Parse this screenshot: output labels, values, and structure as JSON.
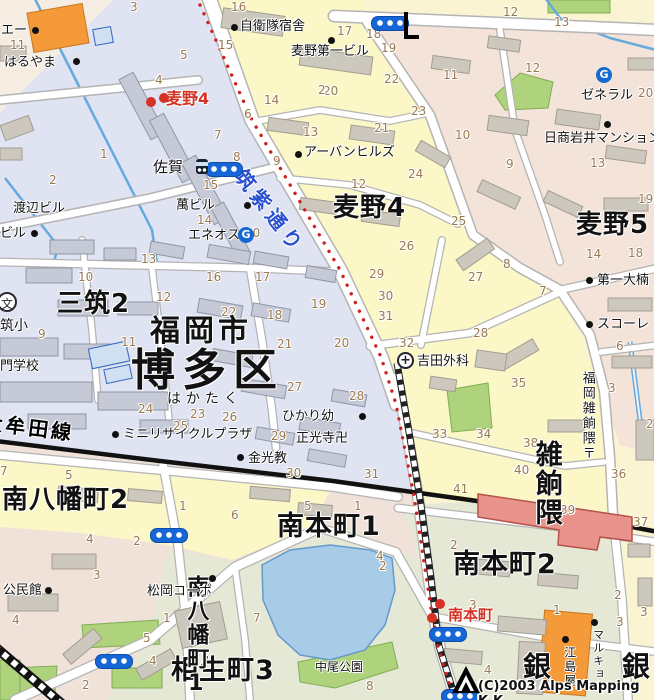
{
  "colors": {
    "ward_boundary_red": "#cc2222",
    "road_name_blue": "#2b50d0",
    "railway_black": "#111111",
    "water_blue": "#a8cbe8",
    "park_green": "#afd27c",
    "station_pink": "#e8948c",
    "store_orange": "#f49a38",
    "signal_blue": "#1766d6",
    "hakata_area_blue": "#dfe3f2",
    "mugino_area_yellow": "#fbf7c6"
  },
  "copyright": {
    "text": "(C)2003 Alps Mapping K.K."
  },
  "districts": [
    {
      "t": "麦野4",
      "x": 333,
      "y": 195,
      "s": 26
    },
    {
      "t": "麦野5",
      "x": 576,
      "y": 212,
      "s": 26
    },
    {
      "t": "三筑2",
      "x": 57,
      "y": 291,
      "s": 26
    },
    {
      "t": "福岡市",
      "x": 150,
      "y": 316,
      "s": 30,
      "c": "ls4"
    },
    {
      "t": "博多区",
      "x": 131,
      "y": 348,
      "s": 44,
      "c": "ls6"
    },
    {
      "t": "はかたく",
      "x": 167,
      "y": 392,
      "s": 14,
      "c": "ls5"
    },
    {
      "t": "南八幡町2",
      "x": 2,
      "y": 487,
      "s": 26
    },
    {
      "t": "南八幡町1",
      "x": 184,
      "y": 575,
      "s": 22,
      "c": "vert"
    },
    {
      "t": "南本町1",
      "x": 277,
      "y": 513,
      "s": 27
    },
    {
      "t": "南本町2",
      "x": 453,
      "y": 551,
      "s": 27
    },
    {
      "t": "相生町3",
      "x": 171,
      "y": 657,
      "s": 27
    },
    {
      "t": "雑餉隈",
      "x": 531,
      "y": 440,
      "s": 27,
      "c": "vert"
    },
    {
      "t": "銀",
      "x": 523,
      "y": 652,
      "s": 28
    },
    {
      "t": "銀",
      "x": 622,
      "y": 652,
      "s": 28
    }
  ],
  "street_labels": [
    {
      "t": "筑紫通り",
      "x": 247,
      "y": 166,
      "r": 52,
      "s": 20,
      "c": "roadname"
    },
    {
      "t": "大牟田線",
      "x": -16,
      "y": 412,
      "r": 7,
      "s": 20,
      "c": "railname"
    }
  ],
  "pois": [
    {
      "t": "自衛隊宿舎",
      "x": 240,
      "y": 20
    },
    {
      "t": "麦野第一ビル",
      "x": 291,
      "y": 45
    },
    {
      "t": "はるやま",
      "x": 4,
      "y": 56
    },
    {
      "t": "エー",
      "x": 1,
      "y": 24
    },
    {
      "t": "渡辺ビル",
      "x": 13,
      "y": 202
    },
    {
      "t": "ビル",
      "x": 0,
      "y": 227
    },
    {
      "t": "萬ビル",
      "x": 176,
      "y": 199
    },
    {
      "t": "エネオス",
      "x": 188,
      "y": 229
    },
    {
      "t": "アーバンヒルズ",
      "x": 304,
      "y": 146
    },
    {
      "t": "ゼネラル",
      "x": 581,
      "y": 89
    },
    {
      "t": "日商岩井マンション",
      "x": 544,
      "y": 132
    },
    {
      "t": "第一大楠",
      "x": 597,
      "y": 274
    },
    {
      "t": "スコーレ",
      "x": 597,
      "y": 318
    },
    {
      "t": "吉田外科",
      "x": 417,
      "y": 355
    },
    {
      "t": "ひかり幼",
      "x": 282,
      "y": 410
    },
    {
      "t": "正光寺卍",
      "x": 296,
      "y": 432
    },
    {
      "t": "金光教",
      "x": 248,
      "y": 452
    },
    {
      "t": "ミニリサイクルプラザ",
      "x": 123,
      "y": 428
    },
    {
      "t": "公民館",
      "x": 3,
      "y": 584
    },
    {
      "t": "松岡コーポ",
      "x": 147,
      "y": 585
    },
    {
      "t": "中尾公園",
      "x": 315,
      "y": 661,
      "s": 12
    },
    {
      "t": "佐賀",
      "x": 153,
      "y": 160,
      "s": 15
    },
    {
      "t": "筑小",
      "x": 0,
      "y": 319,
      "s": 14
    },
    {
      "t": "門学校",
      "x": 0,
      "y": 360
    },
    {
      "t": "江島屋",
      "x": 563,
      "y": 646,
      "s": 12,
      "c": "vert"
    },
    {
      "t": "マルキョウ",
      "x": 592,
      "y": 629,
      "s": 11,
      "c": "vert"
    },
    {
      "t": "福岡雑餉隈〒",
      "x": 580,
      "y": 371,
      "s": 13,
      "c": "vert"
    }
  ],
  "red_stops": [
    {
      "t": "麦野4",
      "x": 166,
      "y": 91,
      "s": 16
    },
    {
      "t": "南本町",
      "x": 448,
      "y": 608,
      "s": 15
    }
  ],
  "numbers": [
    {
      "t": "3",
      "x": 130,
      "y": 1
    },
    {
      "t": "16",
      "x": 231,
      "y": 1
    },
    {
      "t": "17",
      "x": 337,
      "y": 25
    },
    {
      "t": "18",
      "x": 366,
      "y": 28
    },
    {
      "t": "19",
      "x": 381,
      "y": 42
    },
    {
      "t": "12",
      "x": 503,
      "y": 6
    },
    {
      "t": "13",
      "x": 554,
      "y": 16
    },
    {
      "t": "15",
      "x": 218,
      "y": 39
    },
    {
      "t": "5",
      "x": 180,
      "y": 49
    },
    {
      "t": "4",
      "x": 155,
      "y": 74
    },
    {
      "t": "2",
      "x": 318,
      "y": 84
    },
    {
      "t": "14",
      "x": 264,
      "y": 94
    },
    {
      "t": "22",
      "x": 384,
      "y": 73
    },
    {
      "t": "20",
      "x": 323,
      "y": 85
    },
    {
      "t": "6",
      "x": 244,
      "y": 108
    },
    {
      "t": "11",
      "x": 443,
      "y": 69
    },
    {
      "t": "12",
      "x": 525,
      "y": 62
    },
    {
      "t": "13",
      "x": 303,
      "y": 126
    },
    {
      "t": "7",
      "x": 214,
      "y": 129
    },
    {
      "t": "8",
      "x": 233,
      "y": 151
    },
    {
      "t": "9",
      "x": 273,
      "y": 155
    },
    {
      "t": "20",
      "x": 638,
      "y": 87
    },
    {
      "t": "10",
      "x": 455,
      "y": 129
    },
    {
      "t": "9",
      "x": 506,
      "y": 158
    },
    {
      "t": "13",
      "x": 590,
      "y": 157
    },
    {
      "t": "19",
      "x": 638,
      "y": 193
    },
    {
      "t": "23",
      "x": 411,
      "y": 105
    },
    {
      "t": "21",
      "x": 374,
      "y": 122
    },
    {
      "t": "24",
      "x": 408,
      "y": 168
    },
    {
      "t": "12",
      "x": 351,
      "y": 178
    },
    {
      "t": "25",
      "x": 451,
      "y": 215
    },
    {
      "t": "15",
      "x": 203,
      "y": 179
    },
    {
      "t": "14",
      "x": 197,
      "y": 214
    },
    {
      "t": "1",
      "x": 100,
      "y": 148
    },
    {
      "t": "11",
      "x": 10,
      "y": 39
    },
    {
      "t": "2",
      "x": 49,
      "y": 174
    },
    {
      "t": "10",
      "x": 245,
      "y": 227
    },
    {
      "t": "13",
      "x": 141,
      "y": 253
    },
    {
      "t": "10",
      "x": 78,
      "y": 271
    },
    {
      "t": "12",
      "x": 156,
      "y": 291
    },
    {
      "t": "16",
      "x": 206,
      "y": 271
    },
    {
      "t": "17",
      "x": 255,
      "y": 271
    },
    {
      "t": "9",
      "x": 38,
      "y": 328
    },
    {
      "t": "11",
      "x": 121,
      "y": 336
    },
    {
      "t": "22",
      "x": 221,
      "y": 306
    },
    {
      "t": "18",
      "x": 267,
      "y": 309
    },
    {
      "t": "19",
      "x": 311,
      "y": 298
    },
    {
      "t": "21",
      "x": 277,
      "y": 338
    },
    {
      "t": "24",
      "x": 138,
      "y": 403
    },
    {
      "t": "23",
      "x": 190,
      "y": 408
    },
    {
      "t": "26",
      "x": 222,
      "y": 411
    },
    {
      "t": "27",
      "x": 287,
      "y": 381
    },
    {
      "t": "25",
      "x": 173,
      "y": 420
    },
    {
      "t": "29",
      "x": 271,
      "y": 430
    },
    {
      "t": "30",
      "x": 286,
      "y": 467
    },
    {
      "t": "31",
      "x": 364,
      "y": 468
    },
    {
      "t": "33",
      "x": 432,
      "y": 428
    },
    {
      "t": "26",
      "x": 399,
      "y": 240
    },
    {
      "t": "29",
      "x": 369,
      "y": 268
    },
    {
      "t": "30",
      "x": 378,
      "y": 290
    },
    {
      "t": "31",
      "x": 378,
      "y": 310
    },
    {
      "t": "32",
      "x": 399,
      "y": 337
    },
    {
      "t": "27",
      "x": 468,
      "y": 271
    },
    {
      "t": "28",
      "x": 473,
      "y": 327
    },
    {
      "t": "8",
      "x": 503,
      "y": 258
    },
    {
      "t": "7",
      "x": 539,
      "y": 285
    },
    {
      "t": "14",
      "x": 586,
      "y": 248
    },
    {
      "t": "18",
      "x": 628,
      "y": 247
    },
    {
      "t": "20",
      "x": 334,
      "y": 337
    },
    {
      "t": "28",
      "x": 349,
      "y": 390
    },
    {
      "t": "35",
      "x": 511,
      "y": 377
    },
    {
      "t": "34",
      "x": 476,
      "y": 428
    },
    {
      "t": "38",
      "x": 523,
      "y": 437
    },
    {
      "t": "6",
      "x": 616,
      "y": 340
    },
    {
      "t": "3",
      "x": 608,
      "y": 382
    },
    {
      "t": "2",
      "x": 646,
      "y": 418
    },
    {
      "t": "40",
      "x": 514,
      "y": 464
    },
    {
      "t": "41",
      "x": 453,
      "y": 483
    },
    {
      "t": "36",
      "x": 611,
      "y": 468
    },
    {
      "t": "37",
      "x": 633,
      "y": 516
    },
    {
      "t": "39",
      "x": 560,
      "y": 504
    },
    {
      "t": "5",
      "x": 65,
      "y": 469
    },
    {
      "t": "7",
      "x": 0,
      "y": 465
    },
    {
      "t": "4",
      "x": 86,
      "y": 533
    },
    {
      "t": "2",
      "x": 133,
      "y": 535
    },
    {
      "t": "3",
      "x": 93,
      "y": 569
    },
    {
      "t": "6",
      "x": 231,
      "y": 509
    },
    {
      "t": "1",
      "x": 179,
      "y": 500
    },
    {
      "t": "4",
      "x": 12,
      "y": 614
    },
    {
      "t": "1",
      "x": 163,
      "y": 612
    },
    {
      "t": "5",
      "x": 143,
      "y": 632
    },
    {
      "t": "4",
      "x": 149,
      "y": 655
    },
    {
      "t": "2",
      "x": 82,
      "y": 679
    },
    {
      "t": "5",
      "x": 304,
      "y": 500
    },
    {
      "t": "2",
      "x": 450,
      "y": 539
    },
    {
      "t": "3",
      "x": 469,
      "y": 599
    },
    {
      "t": "4",
      "x": 376,
      "y": 550
    },
    {
      "t": "2",
      "x": 379,
      "y": 560
    },
    {
      "t": "1",
      "x": 553,
      "y": 604
    },
    {
      "t": "2",
      "x": 614,
      "y": 589
    },
    {
      "t": "3",
      "x": 616,
      "y": 616
    },
    {
      "t": "4",
      "x": 484,
      "y": 664
    },
    {
      "t": "8",
      "x": 366,
      "y": 680
    },
    {
      "t": "1",
      "x": 354,
      "y": 500
    },
    {
      "t": "7",
      "x": 253,
      "y": 612
    },
    {
      "t": "3",
      "x": 640,
      "y": 606
    }
  ],
  "dots": [
    {
      "x": 231,
      "y": 24
    },
    {
      "x": 328,
      "y": 37
    },
    {
      "x": 73,
      "y": 58
    },
    {
      "x": 32,
      "y": 27
    },
    {
      "x": 31,
      "y": 230
    },
    {
      "x": 244,
      "y": 202
    },
    {
      "x": 295,
      "y": 151
    },
    {
      "x": 604,
      "y": 121
    },
    {
      "x": 586,
      "y": 277
    },
    {
      "x": 586,
      "y": 321
    },
    {
      "x": 359,
      "y": 413
    },
    {
      "x": 237,
      "y": 454
    },
    {
      "x": 112,
      "y": 431
    },
    {
      "x": 45,
      "y": 587
    },
    {
      "x": 209,
      "y": 575
    },
    {
      "x": 562,
      "y": 636
    },
    {
      "x": 591,
      "y": 619
    }
  ],
  "red_dots": [
    {
      "x": 146,
      "y": 97
    },
    {
      "x": 159,
      "y": 93
    },
    {
      "x": 435,
      "y": 599
    },
    {
      "x": 427,
      "y": 613
    }
  ],
  "signals": [
    {
      "x": 205,
      "y": 162
    },
    {
      "x": 371,
      "y": 16
    },
    {
      "x": 150,
      "y": 528
    },
    {
      "x": 95,
      "y": 654
    },
    {
      "x": 429,
      "y": 627
    },
    {
      "x": 441,
      "y": 689
    }
  ],
  "gas_icons": [
    {
      "t": "G",
      "x": 238,
      "y": 227
    },
    {
      "t": "G",
      "x": 596,
      "y": 67
    }
  ],
  "school_icons": [
    {
      "t": "文",
      "x": -3,
      "y": 292
    }
  ],
  "hospital_icons": [
    {
      "t": "+",
      "x": 397,
      "y": 352
    }
  ],
  "busstop_icons": [
    {
      "x": 196,
      "y": 159
    }
  ]
}
